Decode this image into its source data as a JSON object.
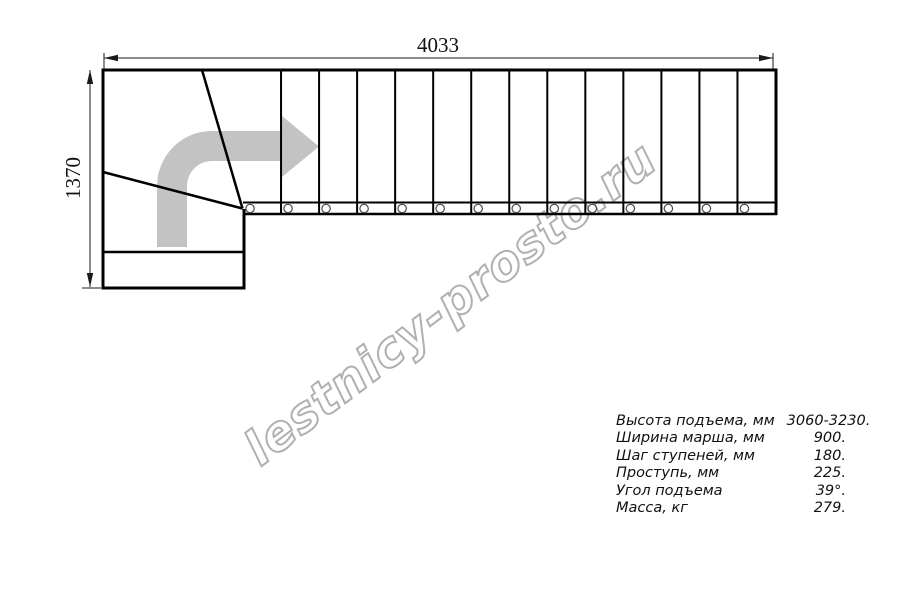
{
  "watermark": {
    "text": "lestnicy-prosto.ru"
  },
  "dimensions": {
    "width_mm": "4033",
    "height_mm": "1370"
  },
  "specs": {
    "rows": [
      {
        "label": "Высота подъема, мм",
        "value": "3060-3230."
      },
      {
        "label": "Ширина марша, мм",
        "value": "900."
      },
      {
        "label": "Шаг ступеней, мм",
        "value": "180."
      },
      {
        "label": "Проступь, мм",
        "value": "225."
      },
      {
        "label": "Угол подъема",
        "value": "39°."
      },
      {
        "label": "Масса, кг",
        "value": "279."
      }
    ]
  },
  "drawing": {
    "straight_flight_steps": 14,
    "baluster_count": 14,
    "flight_left_x": 243,
    "flight_right_x": 775.5,
    "flight_top_y": 70,
    "band_bottom_y": 214,
    "circle_y": 208.5,
    "colors": {
      "line": "#000000",
      "dimension": "#1a1a1a",
      "arrow_fill": "#c3c3c3",
      "circle_stroke": "#4a4a4a",
      "watermark_stroke": "#b0b0b0"
    }
  }
}
